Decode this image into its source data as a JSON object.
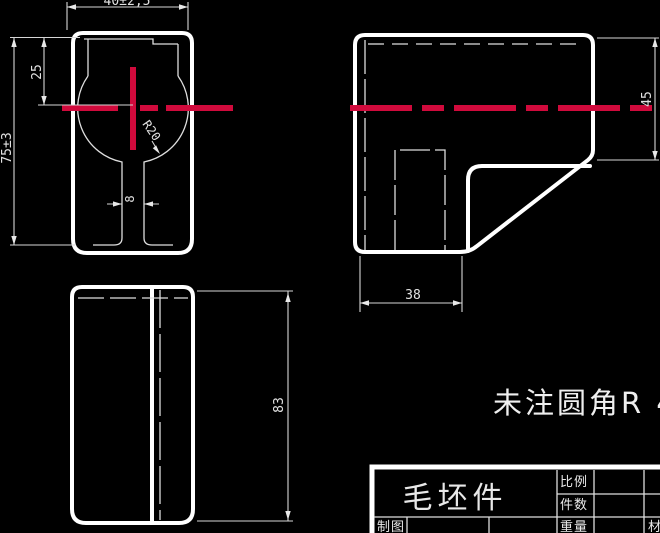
{
  "canvas": {
    "background": "#000000",
    "line_color": "#ffffff",
    "centerline_color": "#d00a3c"
  },
  "dimensions": {
    "front_width": "40±2,5",
    "front_height": "75±3",
    "front_center_offset": "25",
    "front_slot_width": "8",
    "front_radius": "R20",
    "side_height": "45",
    "side_width": "38",
    "top_length": "83"
  },
  "note": "未注圆角R 4",
  "title_block": {
    "part_name": "毛坯件",
    "scale_label": "比例",
    "quantity_label": "件数",
    "weight_label": "重量",
    "drafter_label": "制图",
    "material_label": "材料"
  }
}
